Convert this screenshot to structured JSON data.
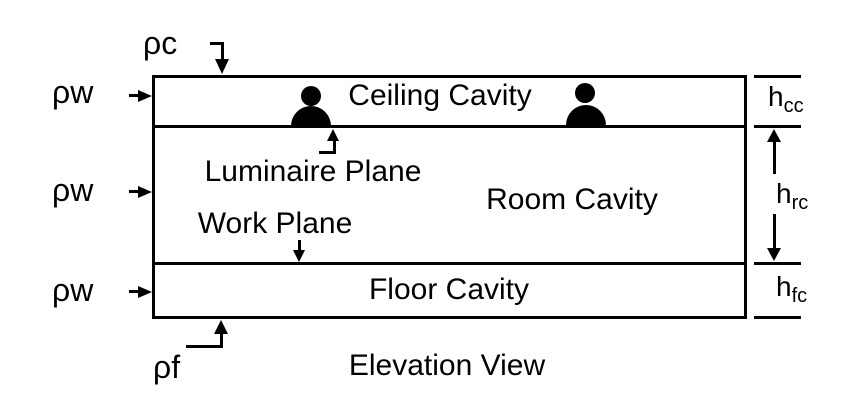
{
  "diagram": {
    "caption": "Elevation View",
    "regions": [
      {
        "id": "ceiling-cavity",
        "label": "Ceiling Cavity"
      },
      {
        "id": "room-cavity",
        "label": "Room Cavity"
      },
      {
        "id": "floor-cavity",
        "label": "Floor Cavity"
      }
    ],
    "planes": [
      {
        "id": "luminaire-plane",
        "label": "Luminaire Plane"
      },
      {
        "id": "work-plane",
        "label": "Work Plane"
      }
    ],
    "reflectances": {
      "ceiling": "ρc",
      "wall": "ρw",
      "floor": "ρf"
    },
    "dimensions": [
      {
        "id": "ceiling-cavity-height",
        "base": "h",
        "sub": "cc"
      },
      {
        "id": "room-cavity-height",
        "base": "h",
        "sub": "rc"
      },
      {
        "id": "floor-cavity-height",
        "base": "h",
        "sub": "fc"
      }
    ],
    "luminaire_count": 2,
    "colors": {
      "stroke": "#000000",
      "background": "#ffffff"
    }
  }
}
